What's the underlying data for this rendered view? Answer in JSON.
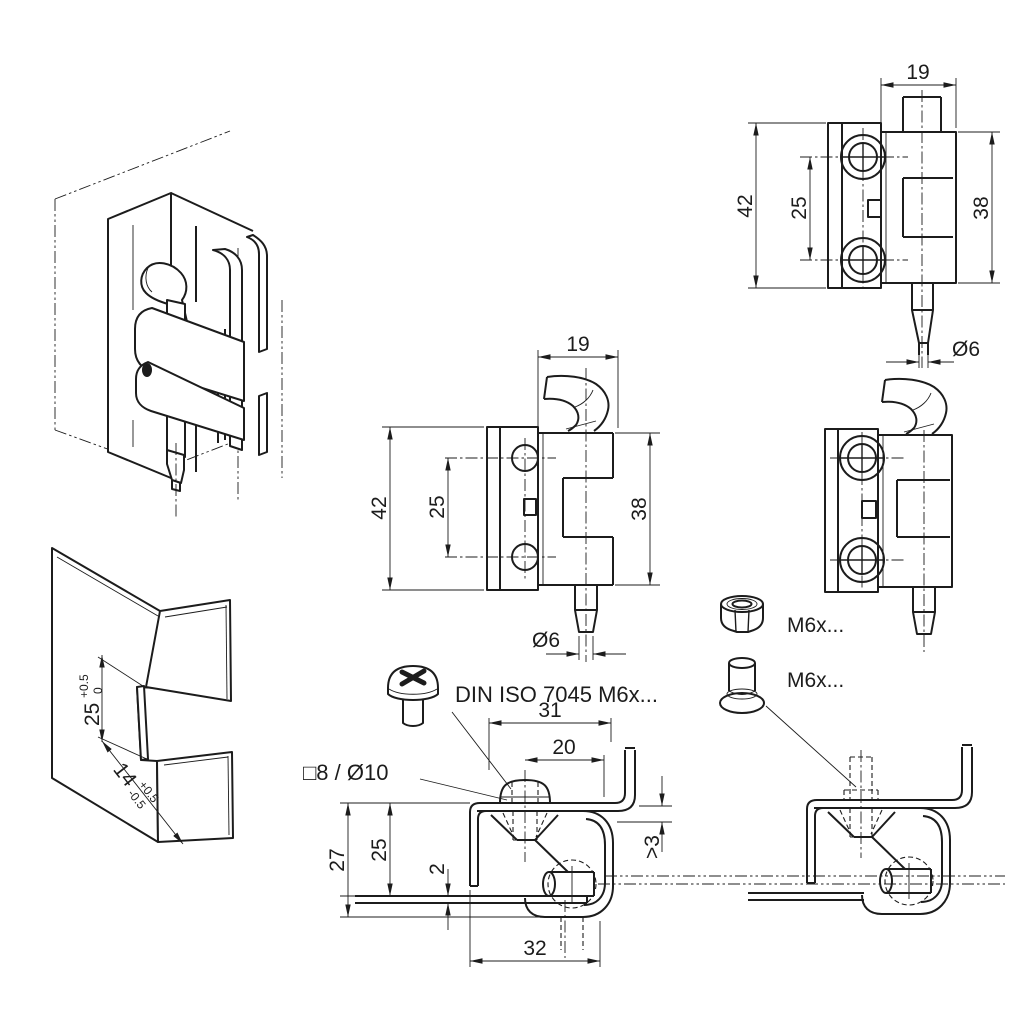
{
  "drawing": {
    "background": "#ffffff",
    "line_color": "#1c1c1c",
    "front_view_hook": {
      "width_mm": "19",
      "height_mm": "42",
      "hole_spacing_mm": "25",
      "leaf_height_mm": "38",
      "pin_diameter": "Ø6"
    },
    "front_view_pin": {
      "width_mm": "19",
      "height_mm": "42",
      "hole_spacing_mm": "25",
      "leaf_height_mm": "38",
      "pin_diameter": "Ø6"
    },
    "section_view": {
      "width_top": "31",
      "stud_spacing": "20",
      "frame_depth": "27",
      "panel_offset": "25",
      "sheet_thickness": "2",
      "width_bottom": "32",
      "min_clearance": ">3",
      "hole_spec": "□8  /  Ø10"
    },
    "fasteners": {
      "screw_spec": "DIN ISO 7045 M6x...",
      "nut_spec": "M6x...",
      "stud_spec": "M6x..."
    },
    "cutout_view": {
      "notch_height": "25",
      "notch_height_tol_up": "+0.5",
      "notch_height_tol_low": "0",
      "notch_width": "14",
      "notch_width_tol_up": "+0.5",
      "notch_width_tol_low": "-0.5"
    }
  }
}
